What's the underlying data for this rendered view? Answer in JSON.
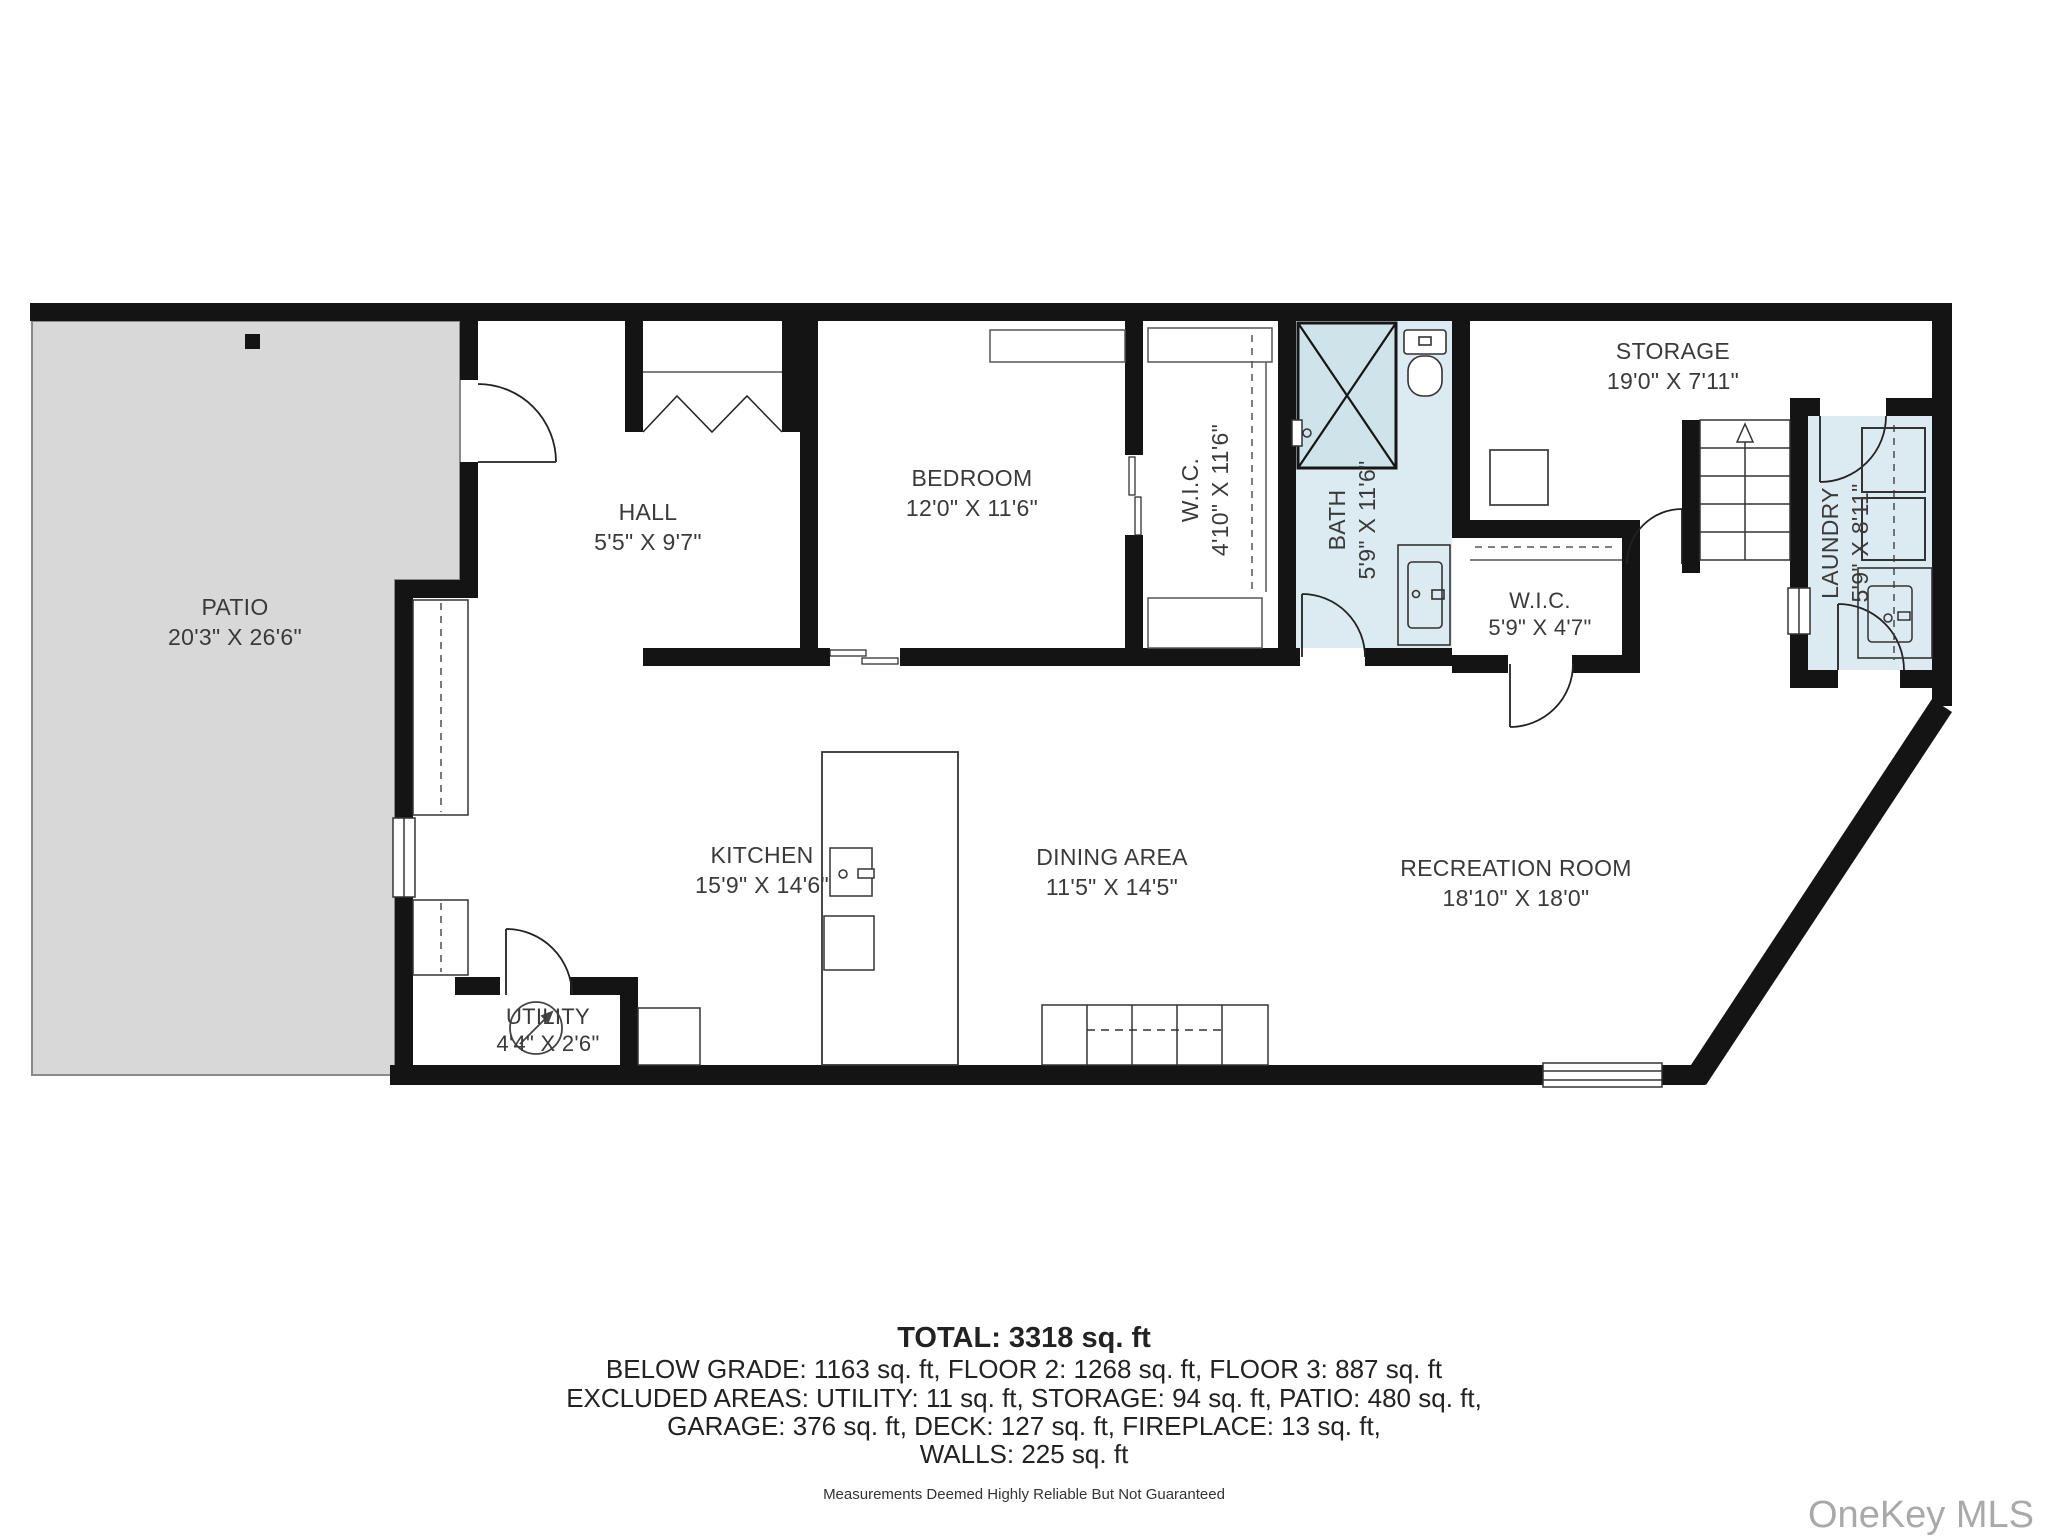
{
  "rooms": {
    "patio": {
      "name": "PATIO",
      "dims": "20'3\" X 26'6\""
    },
    "hall": {
      "name": "HALL",
      "dims": "5'5\" X 9'7\""
    },
    "bedroom": {
      "name": "BEDROOM",
      "dims": "12'0\" X 11'6\""
    },
    "wic1": {
      "name": "W.I.C.",
      "dims": "4'10\" X 11'6\""
    },
    "bath": {
      "name": "BATH",
      "dims": "5'9\" X 11'6\""
    },
    "storage": {
      "name": "STORAGE",
      "dims": "19'0\" X 7'11\""
    },
    "wic2": {
      "name": "W.I.C.",
      "dims": "5'9\" X 4'7\""
    },
    "laundry": {
      "name": "LAUNDRY",
      "dims": "5'9\" X 8'11\""
    },
    "kitchen": {
      "name": "KITCHEN",
      "dims": "15'9\" X 14'6\""
    },
    "dining": {
      "name": "DINING AREA",
      "dims": "11'5\" X 14'5\""
    },
    "rec": {
      "name": "RECREATION ROOM",
      "dims": "18'10\" X 18'0\""
    },
    "utility": {
      "name": "UTILITY",
      "dims": "4'4\" X 2'6\""
    }
  },
  "summary": {
    "total": "TOTAL: 3318 sq. ft",
    "line1": "BELOW GRADE: 1163 sq. ft, FLOOR 2: 1268 sq. ft, FLOOR 3: 887 sq. ft",
    "line2": "EXCLUDED AREAS: UTILITY: 11 sq. ft, STORAGE: 94 sq. ft, PATIO: 480 sq. ft,",
    "line3": "GARAGE: 376 sq. ft, DECK: 127 sq. ft, FIREPLACE: 13 sq. ft,",
    "line4": "WALLS: 225 sq. ft",
    "disclaimer": "Measurements Deemed Highly Reliable But Not Guaranteed"
  },
  "watermark": "OneKey MLS",
  "colors": {
    "wall": "#141414",
    "patio_fill": "#d8d8d8",
    "wet_fill": "#dcebf1",
    "shower_fill": "#cfe3ea"
  }
}
